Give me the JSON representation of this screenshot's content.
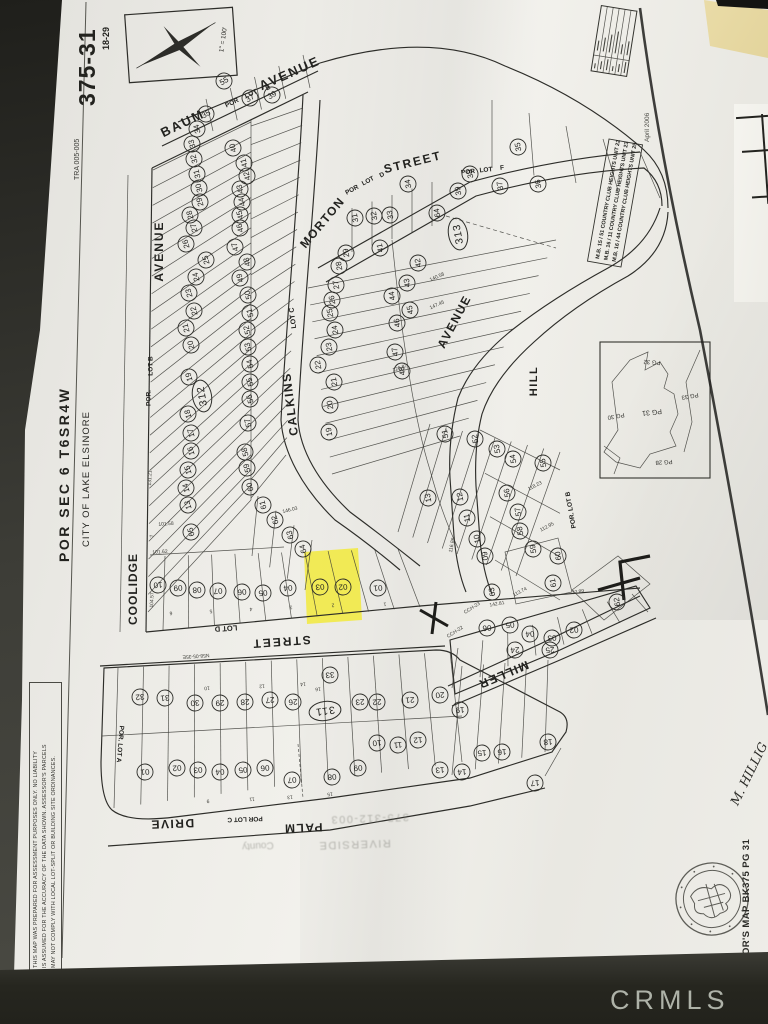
{
  "photo": {
    "watermark": "CRMLS"
  },
  "page": {
    "map_number": "375-31",
    "cross_ref": "18-29",
    "tra": "TRA 005-005",
    "section_title": "POR SEC 6 T6SR4W",
    "city": "CITY OF LAKE ELSINORE",
    "scale": "1\" = 100'",
    "date": "April 2006",
    "assessor_label": "ASSESSOR'S MAP BK375 PG 31",
    "handwriting": "M. HILLIG",
    "disclaimer": [
      "THIS MAP WAS PREPARED FOR ASSESSMENT PURPOSES ONLY. NO LIABILITY",
      "IS ASSUMED FOR THE ACCURACY OF THE DATA SHOWN. ASSESSOR'S PARCELS",
      "MAY NOT COMPLY WITH LOCAL LOT-SPLIT OR BUILDING SITE ORDINANCES."
    ],
    "mb_references": [
      "M.B. 15 / 51   COUNTRY CLUB HEIGHTS UNIT 22",
      "M.B. 16 / 11   COUNTRY CLUB HEIGHTS UNIT 23",
      "M.B. 16 / 44   COUNTRY CLUB HEIGHTS UNIT 25"
    ],
    "stamps": {
      "parcel": "375-312-003",
      "county_line1": "County",
      "county_line2": "RIVERSIDE"
    }
  },
  "map": {
    "highlight_color": "#f2ea3c",
    "highlighted_lots": [
      "03",
      "02"
    ],
    "street_names": [
      "BAUM AVENUE",
      "COOLIDGE AVENUE",
      "CALKINS AVENUE",
      "MORTON STREET",
      "HILL AVENUE",
      "MILLER",
      "PALM DRIVE",
      "STREET"
    ],
    "block_ellipses": [
      [
        "312",
        202,
        396,
        -100
      ],
      [
        "313",
        458,
        234,
        -100
      ],
      [
        "311",
        325,
        711,
        172
      ]
    ],
    "street_labels": [
      [
        "BAUM",
        183,
        124,
        -26,
        13,
        2
      ],
      [
        "POR",
        232,
        103,
        -26,
        6.5,
        0
      ],
      [
        "LOT",
        251,
        94,
        -26,
        6.5,
        0
      ],
      [
        "E",
        268,
        88,
        -26,
        6.5,
        0
      ],
      [
        "AVENUE",
        290,
        74,
        -24,
        13,
        2
      ],
      [
        "AVENUE",
        160,
        251,
        -90,
        12,
        2
      ],
      [
        "COOLIDGE",
        134,
        589,
        -90,
        12,
        1
      ],
      [
        "LOT  C",
        293,
        318,
        -97,
        7,
        0
      ],
      [
        "CALKINS",
        291,
        404,
        -97,
        12,
        1.5
      ],
      [
        "MORTON",
        323,
        223,
        -50,
        12,
        1.5
      ],
      [
        "POR",
        352,
        190,
        -28,
        6.5,
        0
      ],
      [
        "LOT",
        368,
        181,
        -28,
        6.5,
        0
      ],
      [
        "D",
        382,
        175,
        -28,
        6.5,
        0
      ],
      [
        "STREET",
        413,
        163,
        -14,
        12,
        2
      ],
      [
        "POR",
        468,
        172,
        -6,
        6.5,
        0
      ],
      [
        "LOT",
        486,
        170,
        -6,
        6.5,
        0
      ],
      [
        "F",
        502,
        168,
        -6,
        6.5,
        0
      ],
      [
        "AVENUE",
        455,
        322,
        -62,
        12,
        1.5
      ],
      [
        "HILL",
        534,
        381,
        -90,
        11,
        1.5
      ],
      [
        "POR.",
        149,
        398,
        -90,
        6.5,
        0
      ],
      [
        "LOT  B",
        151,
        366,
        -90,
        6.5,
        0
      ],
      [
        "POR.  LOT  B",
        571,
        510,
        -100,
        6.5,
        0
      ],
      [
        "LOT  D",
        226,
        628,
        176,
        7.5,
        0
      ],
      [
        "STREET",
        281,
        641,
        176,
        12,
        2
      ],
      [
        "MILLER",
        503,
        674,
        157,
        12,
        1.5
      ],
      [
        "POR.  LOT  A",
        120,
        744,
        95,
        6.5,
        0
      ],
      [
        "DRIVE",
        172,
        823,
        178,
        12,
        1.5
      ],
      [
        "POR LOT C",
        245,
        819,
        178,
        6.5,
        0
      ],
      [
        "PALM",
        303,
        827,
        178,
        12,
        1.5
      ]
    ],
    "dim_labels": [
      [
        "N58-05-35E",
        196,
        656,
        176
      ],
      [
        "104.57",
        152,
        600,
        -88
      ],
      [
        "101.58",
        166,
        524,
        -4
      ],
      [
        "101.62",
        160,
        552,
        -4
      ],
      [
        "131.21",
        150,
        478,
        -88
      ],
      [
        "146.03",
        290,
        510,
        -14
      ],
      [
        "113.74",
        520,
        592,
        -28
      ],
      [
        "112.95",
        547,
        527,
        -28
      ],
      [
        "118.23",
        535,
        486,
        -28
      ],
      [
        "116.86",
        452,
        545,
        -80
      ],
      [
        "142.81",
        497,
        604,
        -10
      ],
      [
        "72.89",
        578,
        592,
        -10
      ],
      [
        "126.87",
        400,
        368,
        -18
      ],
      [
        "147.45",
        437,
        305,
        -24
      ],
      [
        "140.58",
        437,
        277,
        -24
      ],
      [
        "CCH-23",
        472,
        608,
        -33
      ],
      [
        "CCH-22",
        455,
        632,
        -33
      ],
      [
        "1",
        385,
        604,
        176
      ],
      [
        "2",
        333,
        605,
        176
      ],
      [
        "3",
        291,
        607,
        176
      ],
      [
        "4",
        251,
        609,
        176
      ],
      [
        "5",
        211,
        611,
        176
      ],
      [
        "6",
        171,
        613,
        176
      ],
      [
        "7",
        152,
        536,
        -100
      ],
      [
        "10",
        207,
        688,
        175
      ],
      [
        "12",
        262,
        686,
        175
      ],
      [
        "14",
        303,
        684,
        175
      ],
      [
        "16",
        318,
        689,
        175
      ],
      [
        "9",
        208,
        801,
        175
      ],
      [
        "11",
        252,
        799,
        175
      ],
      [
        "13",
        290,
        797,
        175
      ],
      [
        "15",
        330,
        794,
        175
      ]
    ],
    "lot_markers": [
      [
        "34",
        197,
        129,
        -105
      ],
      [
        "33",
        192,
        144,
        -105
      ],
      [
        "32",
        194,
        159,
        -105
      ],
      [
        "31",
        197,
        174,
        -105
      ],
      [
        "30",
        199,
        188,
        -105
      ],
      [
        "29",
        200,
        202,
        -105
      ],
      [
        "28",
        190,
        215,
        -105
      ],
      [
        "27",
        194,
        228,
        -105
      ],
      [
        "26",
        186,
        244,
        -105
      ],
      [
        "25",
        206,
        260,
        -105
      ],
      [
        "24",
        196,
        277,
        -105
      ],
      [
        "23",
        189,
        293,
        -105
      ],
      [
        "22",
        194,
        311,
        -105
      ],
      [
        "21",
        186,
        328,
        -105
      ],
      [
        "20",
        191,
        345,
        -105
      ],
      [
        "19",
        189,
        377,
        -105
      ],
      [
        "18",
        188,
        414,
        -105
      ],
      [
        "17",
        191,
        433,
        -105
      ],
      [
        "16",
        191,
        451,
        -105
      ],
      [
        "15",
        188,
        470,
        -105
      ],
      [
        "14",
        186,
        488,
        -105
      ],
      [
        "13",
        188,
        505,
        -105
      ],
      [
        "65",
        191,
        532,
        -105
      ],
      [
        "40",
        233,
        148,
        -105
      ],
      [
        "41",
        244,
        163,
        -105
      ],
      [
        "42",
        247,
        176,
        -105
      ],
      [
        "43",
        240,
        189,
        -105
      ],
      [
        "44",
        242,
        202,
        -105
      ],
      [
        "45",
        240,
        215,
        -105
      ],
      [
        "46",
        240,
        228,
        -105
      ],
      [
        "47",
        235,
        247,
        -105
      ],
      [
        "48",
        247,
        262,
        -105
      ],
      [
        "49",
        240,
        278,
        -105
      ],
      [
        "50",
        248,
        295,
        -105
      ],
      [
        "51",
        250,
        313,
        -105
      ],
      [
        "52",
        247,
        330,
        -105
      ],
      [
        "53",
        248,
        347,
        -105
      ],
      [
        "54",
        250,
        364,
        -105
      ],
      [
        "55",
        250,
        382,
        -105
      ],
      [
        "56",
        250,
        399,
        -105
      ],
      [
        "57",
        248,
        423,
        -105
      ],
      [
        "58",
        245,
        452,
        -105
      ],
      [
        "59",
        247,
        468,
        -105
      ],
      [
        "60",
        250,
        487,
        -105
      ],
      [
        "61",
        263,
        505,
        -105
      ],
      [
        "62",
        275,
        520,
        -105
      ],
      [
        "63",
        290,
        535,
        -105
      ],
      [
        "64",
        303,
        549,
        -105
      ],
      [
        "10",
        158,
        585,
        175
      ],
      [
        "09",
        178,
        588,
        175
      ],
      [
        "08",
        197,
        590,
        175
      ],
      [
        "07",
        218,
        591,
        175
      ],
      [
        "06",
        242,
        592,
        175
      ],
      [
        "05",
        263,
        593,
        175
      ],
      [
        "04",
        288,
        588,
        175
      ],
      [
        "03",
        320,
        587,
        175
      ],
      [
        "02",
        343,
        587,
        175
      ],
      [
        "01",
        378,
        588,
        175
      ],
      [
        "35",
        206,
        114,
        -30
      ],
      [
        "55",
        224,
        81,
        -30
      ],
      [
        "37",
        250,
        98,
        -30
      ],
      [
        "39",
        272,
        95,
        -30
      ],
      [
        "39",
        458,
        191,
        -100
      ],
      [
        "38",
        470,
        174,
        -100
      ],
      [
        "37",
        500,
        186,
        -100
      ],
      [
        "36",
        538,
        184,
        -100
      ],
      [
        "35",
        518,
        147,
        -100
      ],
      [
        "34",
        408,
        184,
        -100
      ],
      [
        "33",
        390,
        215,
        -100
      ],
      [
        "32",
        374,
        216,
        -100
      ],
      [
        "31",
        355,
        218,
        -100
      ],
      [
        "29",
        346,
        253,
        -100
      ],
      [
        "28",
        339,
        266,
        -100
      ],
      [
        "27",
        336,
        285,
        -100
      ],
      [
        "26",
        332,
        300,
        -100
      ],
      [
        "25",
        330,
        313,
        -100
      ],
      [
        "24",
        335,
        330,
        -100
      ],
      [
        "23",
        329,
        347,
        -100
      ],
      [
        "22",
        318,
        365,
        -100
      ],
      [
        "21",
        334,
        382,
        -100
      ],
      [
        "20",
        330,
        405,
        -100
      ],
      [
        "19",
        329,
        432,
        -100
      ],
      [
        "64",
        437,
        213,
        -100
      ],
      [
        "41",
        380,
        248,
        -100
      ],
      [
        "42",
        418,
        263,
        -100
      ],
      [
        "43",
        407,
        283,
        -100
      ],
      [
        "44",
        392,
        296,
        -100
      ],
      [
        "45",
        410,
        310,
        -100
      ],
      [
        "46",
        397,
        323,
        -100
      ],
      [
        "47",
        395,
        352,
        -100
      ],
      [
        "48",
        402,
        371,
        -100
      ],
      [
        "51",
        445,
        434,
        -100
      ],
      [
        "52",
        475,
        439,
        -100
      ],
      [
        "53",
        497,
        449,
        -100
      ],
      [
        "54",
        513,
        459,
        -100
      ],
      [
        "55",
        543,
        463,
        -100
      ],
      [
        "56",
        507,
        493,
        -100
      ],
      [
        "57",
        518,
        512,
        -100
      ],
      [
        "58",
        520,
        531,
        -100
      ],
      [
        "59",
        533,
        549,
        -100
      ],
      [
        "60",
        558,
        556,
        -100
      ],
      [
        "61",
        553,
        583,
        -100
      ],
      [
        "62",
        617,
        602,
        -100
      ],
      [
        "63",
        492,
        592,
        -100
      ],
      [
        "13",
        428,
        498,
        -100
      ],
      [
        "12",
        460,
        497,
        -100
      ],
      [
        "11",
        467,
        518,
        -100
      ],
      [
        "10",
        477,
        539,
        -100
      ],
      [
        "09",
        485,
        556,
        -100
      ],
      [
        "06",
        487,
        628,
        175
      ],
      [
        "05",
        510,
        625,
        175
      ],
      [
        "04",
        530,
        634,
        175
      ],
      [
        "03",
        552,
        638,
        175
      ],
      [
        "02",
        574,
        630,
        175
      ],
      [
        "24",
        515,
        650,
        175
      ],
      [
        "25",
        550,
        650,
        175
      ],
      [
        "32",
        140,
        697,
        175
      ],
      [
        "31",
        165,
        698,
        175
      ],
      [
        "30",
        195,
        703,
        175
      ],
      [
        "29",
        220,
        703,
        175
      ],
      [
        "28",
        245,
        702,
        175
      ],
      [
        "27",
        270,
        700,
        175
      ],
      [
        "26",
        293,
        702,
        175
      ],
      [
        "33",
        330,
        675,
        175
      ],
      [
        "01",
        145,
        772,
        175
      ],
      [
        "02",
        177,
        768,
        175
      ],
      [
        "03",
        198,
        770,
        175
      ],
      [
        "04",
        220,
        772,
        175
      ],
      [
        "05",
        243,
        770,
        175
      ],
      [
        "06",
        265,
        768,
        175
      ],
      [
        "07",
        292,
        780,
        175
      ],
      [
        "08",
        332,
        777,
        175
      ],
      [
        "23",
        360,
        702,
        175
      ],
      [
        "22",
        377,
        702,
        175
      ],
      [
        "21",
        410,
        700,
        175
      ],
      [
        "20",
        440,
        695,
        175
      ],
      [
        "19",
        460,
        710,
        175
      ],
      [
        "09",
        358,
        768,
        175
      ],
      [
        "10",
        377,
        743,
        175
      ],
      [
        "11",
        398,
        745,
        175
      ],
      [
        "12",
        418,
        740,
        175
      ],
      [
        "13",
        440,
        770,
        175
      ],
      [
        "14",
        462,
        772,
        175
      ],
      [
        "15",
        482,
        753,
        175
      ],
      [
        "16",
        502,
        752,
        175
      ],
      [
        "18",
        548,
        742,
        175
      ],
      [
        "17",
        535,
        783,
        175
      ]
    ],
    "inset": {
      "labels": [
        [
          "PG 31",
          652,
          412,
          174,
          7
        ],
        [
          "PG 30",
          616,
          416,
          170,
          6
        ],
        [
          "PG 32",
          652,
          362,
          184,
          6
        ],
        [
          "PG 33",
          690,
          396,
          170,
          6
        ],
        [
          "PG 28",
          664,
          462,
          176,
          6
        ]
      ]
    }
  }
}
